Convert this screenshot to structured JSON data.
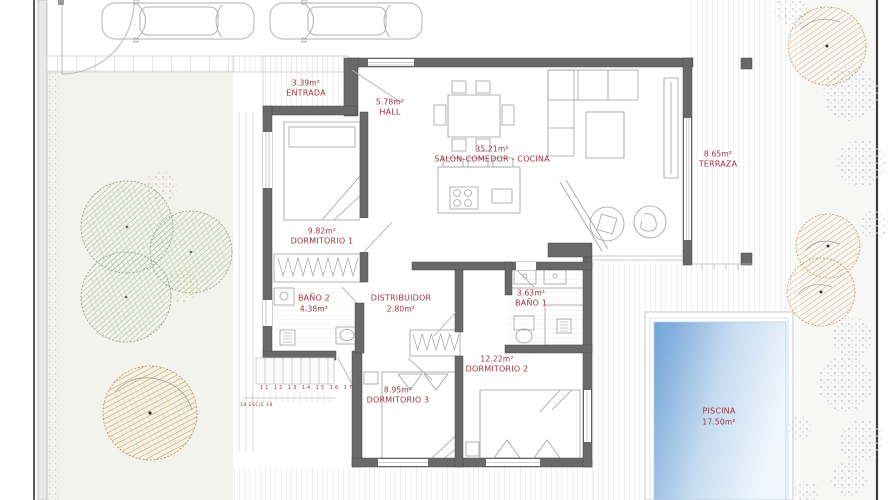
{
  "plan": {
    "rooms": {
      "entrada": {
        "lines": [
          "3.39m²",
          "ENTRADA"
        ]
      },
      "hall": {
        "lines": [
          "5.78m²",
          "HALL"
        ]
      },
      "salon": {
        "lines": [
          "35.21m²",
          "SALÓN-COMEDOR - COCINA"
        ]
      },
      "terraza": {
        "lines": [
          "8.65m²",
          "TERRAZA"
        ]
      },
      "dormitorio1": {
        "lines": [
          "9.82m²",
          "DORMITORIO 1"
        ]
      },
      "bano2": {
        "lines": [
          "BAÑO 2",
          "4.38m²"
        ]
      },
      "distribuidor": {
        "lines": [
          "DISTRIBUIDOR",
          "2.80m²"
        ]
      },
      "bano1": {
        "lines": [
          "3.63m²",
          "BAÑO 1"
        ]
      },
      "dormitorio2": {
        "lines": [
          "12.22m²",
          "DORMITORIO 2"
        ]
      },
      "dormitorio3": {
        "lines": [
          "8.95m²",
          "DORMITORIO 3"
        ]
      },
      "piscina": {
        "lines": [
          "PISCINA",
          "17.50m²"
        ]
      }
    },
    "stairs": {
      "step_numbers": "11 12 13 14 15 16 17",
      "note": "18 ESC/E 18"
    },
    "colors": {
      "wall": "#696969",
      "label": "#a03242",
      "pool_deep": "#6fa1d6",
      "pool_light": "#eff6fc",
      "tree_green": "#9fae8a",
      "tree_orange": "#e6932c",
      "tree_tan": "#d8a66a",
      "speckle_purple": "#c7bfd8"
    }
  }
}
